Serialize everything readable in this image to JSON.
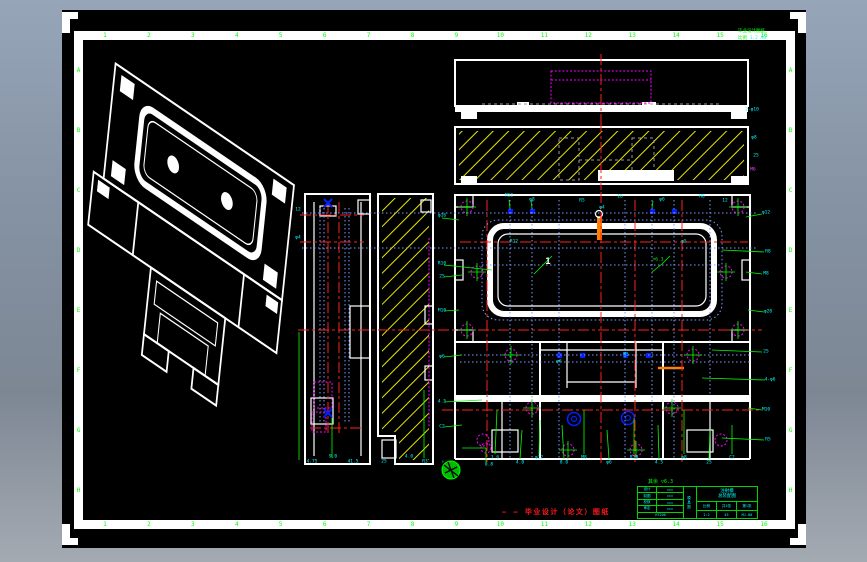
{
  "window": {
    "background_top": "#96a5b8",
    "background_bottom": "#a4aab2",
    "canvas_color": "#000000"
  },
  "colors": {
    "outline": "#ffffff",
    "zone_labels": "#00ff00",
    "dimensions": "#00ffff",
    "hatch": "#e8e800",
    "centerline": "#ff2020",
    "hidden_line": "#7d9dff",
    "bolt_circle": "#ff00ff",
    "section_mark": "#0020ff",
    "leader": "#00ff00",
    "caption": "#ff1a1a"
  },
  "frame": {
    "columns": [
      "1",
      "2",
      "3",
      "4",
      "5",
      "6",
      "7",
      "8",
      "9",
      "10",
      "11",
      "12",
      "13",
      "14",
      "15",
      "16"
    ],
    "rows_left": [
      "A",
      "B",
      "C",
      "D",
      "E",
      "F",
      "G",
      "H"
    ],
    "rows_right": [
      "A",
      "B",
      "C",
      "D",
      "E",
      "F",
      "G",
      "H"
    ]
  },
  "note_top_right": {
    "line1": "毕业设计图纸",
    "line2_green": "比例",
    "line2_cyan": "1:2 A0"
  },
  "caption": {
    "text": "— — 毕业设计（论文）图纸"
  },
  "surface_note": "其余 ▽6.3",
  "title_block": {
    "rows": [
      {
        "label": "设计",
        "value": "×××"
      },
      {
        "label": "制图",
        "value": "×××"
      },
      {
        "label": "校核",
        "value": "×××"
      },
      {
        "label": "审定",
        "value": "×××"
      }
    ],
    "bottom_code": "HT200",
    "mid_col": "模具图",
    "title_line1": "注射模",
    "title_line2": "总装配图",
    "cells": {
      "scale_label": "比例",
      "sheets": "共1张",
      "sheet_no": "第1张",
      "scale": "1:2",
      "material": "45",
      "code": "MJ-00"
    }
  },
  "annotations": [
    {
      "x": 690,
      "y": 100,
      "t": "2-φ10"
    },
    {
      "x": 692,
      "y": 128,
      "t": "φ8"
    },
    {
      "x": 694,
      "y": 146,
      "t": "25"
    },
    {
      "x": 691,
      "y": 160,
      "t": "M6",
      "c": "m"
    },
    {
      "x": 447,
      "y": 186,
      "t": "M12"
    },
    {
      "x": 470,
      "y": 190,
      "t": "φ8"
    },
    {
      "x": 520,
      "y": 191,
      "t": "R5"
    },
    {
      "x": 558,
      "y": 187,
      "t": "16"
    },
    {
      "x": 600,
      "y": 190,
      "t": "φ6"
    },
    {
      "x": 640,
      "y": 187,
      "t": "M8"
    },
    {
      "x": 663,
      "y": 191,
      "t": "12"
    },
    {
      "x": 540,
      "y": 198,
      "t": "φ4"
    },
    {
      "x": 380,
      "y": 206,
      "t": "φ16"
    },
    {
      "x": 380,
      "y": 254,
      "t": "R10"
    },
    {
      "x": 380,
      "y": 267,
      "t": "25"
    },
    {
      "x": 380,
      "y": 301,
      "t": "M10"
    },
    {
      "x": 380,
      "y": 347,
      "t": "φ6"
    },
    {
      "x": 380,
      "y": 392,
      "t": "4.5"
    },
    {
      "x": 380,
      "y": 417,
      "t": "C2"
    },
    {
      "x": 704,
      "y": 203,
      "t": "φ12"
    },
    {
      "x": 706,
      "y": 242,
      "t": "R8"
    },
    {
      "x": 704,
      "y": 264,
      "t": "M8"
    },
    {
      "x": 706,
      "y": 302,
      "t": "φ20"
    },
    {
      "x": 704,
      "y": 342,
      "t": "25"
    },
    {
      "x": 708,
      "y": 370,
      "t": "4-φ6"
    },
    {
      "x": 704,
      "y": 400,
      "t": "M10"
    },
    {
      "x": 706,
      "y": 430,
      "t": "R5"
    },
    {
      "x": 433,
      "y": 448,
      "t": "1.6"
    },
    {
      "x": 458,
      "y": 453,
      "t": "4.0"
    },
    {
      "x": 477,
      "y": 448,
      "t": "φ12"
    },
    {
      "x": 502,
      "y": 453,
      "t": "8.0"
    },
    {
      "x": 522,
      "y": 448,
      "t": "M8"
    },
    {
      "x": 547,
      "y": 453,
      "t": "φ6"
    },
    {
      "x": 572,
      "y": 448,
      "t": "R10"
    },
    {
      "x": 597,
      "y": 453,
      "t": "4.5"
    },
    {
      "x": 622,
      "y": 448,
      "t": "φ8"
    },
    {
      "x": 647,
      "y": 453,
      "t": "25"
    },
    {
      "x": 670,
      "y": 448,
      "t": "C2"
    },
    {
      "x": 250,
      "y": 452,
      "t": "4.75"
    },
    {
      "x": 271,
      "y": 447,
      "t": "9.0"
    },
    {
      "x": 291,
      "y": 452,
      "t": "41.5"
    },
    {
      "x": 322,
      "y": 452,
      "t": "25"
    },
    {
      "x": 347,
      "y": 447,
      "t": "4.0"
    },
    {
      "x": 363,
      "y": 452,
      "t": "R3"
    },
    {
      "x": 236,
      "y": 200,
      "t": "12"
    },
    {
      "x": 236,
      "y": 228,
      "t": "φ4"
    },
    {
      "x": 486,
      "y": 252,
      "t": "1",
      "c": "w"
    },
    {
      "x": 596,
      "y": 250,
      "t": "▽6.3",
      "c": "g"
    },
    {
      "x": 452,
      "y": 232,
      "t": "R12"
    },
    {
      "x": 622,
      "y": 232,
      "t": "φ5"
    },
    {
      "x": 381,
      "y": 452,
      "t": "↓"
    },
    {
      "x": 427,
      "y": 455,
      "t": "0.8"
    },
    {
      "x": 564,
      "y": 345,
      "t": "M5"
    },
    {
      "x": 497,
      "y": 352,
      "t": "φ6"
    }
  ]
}
